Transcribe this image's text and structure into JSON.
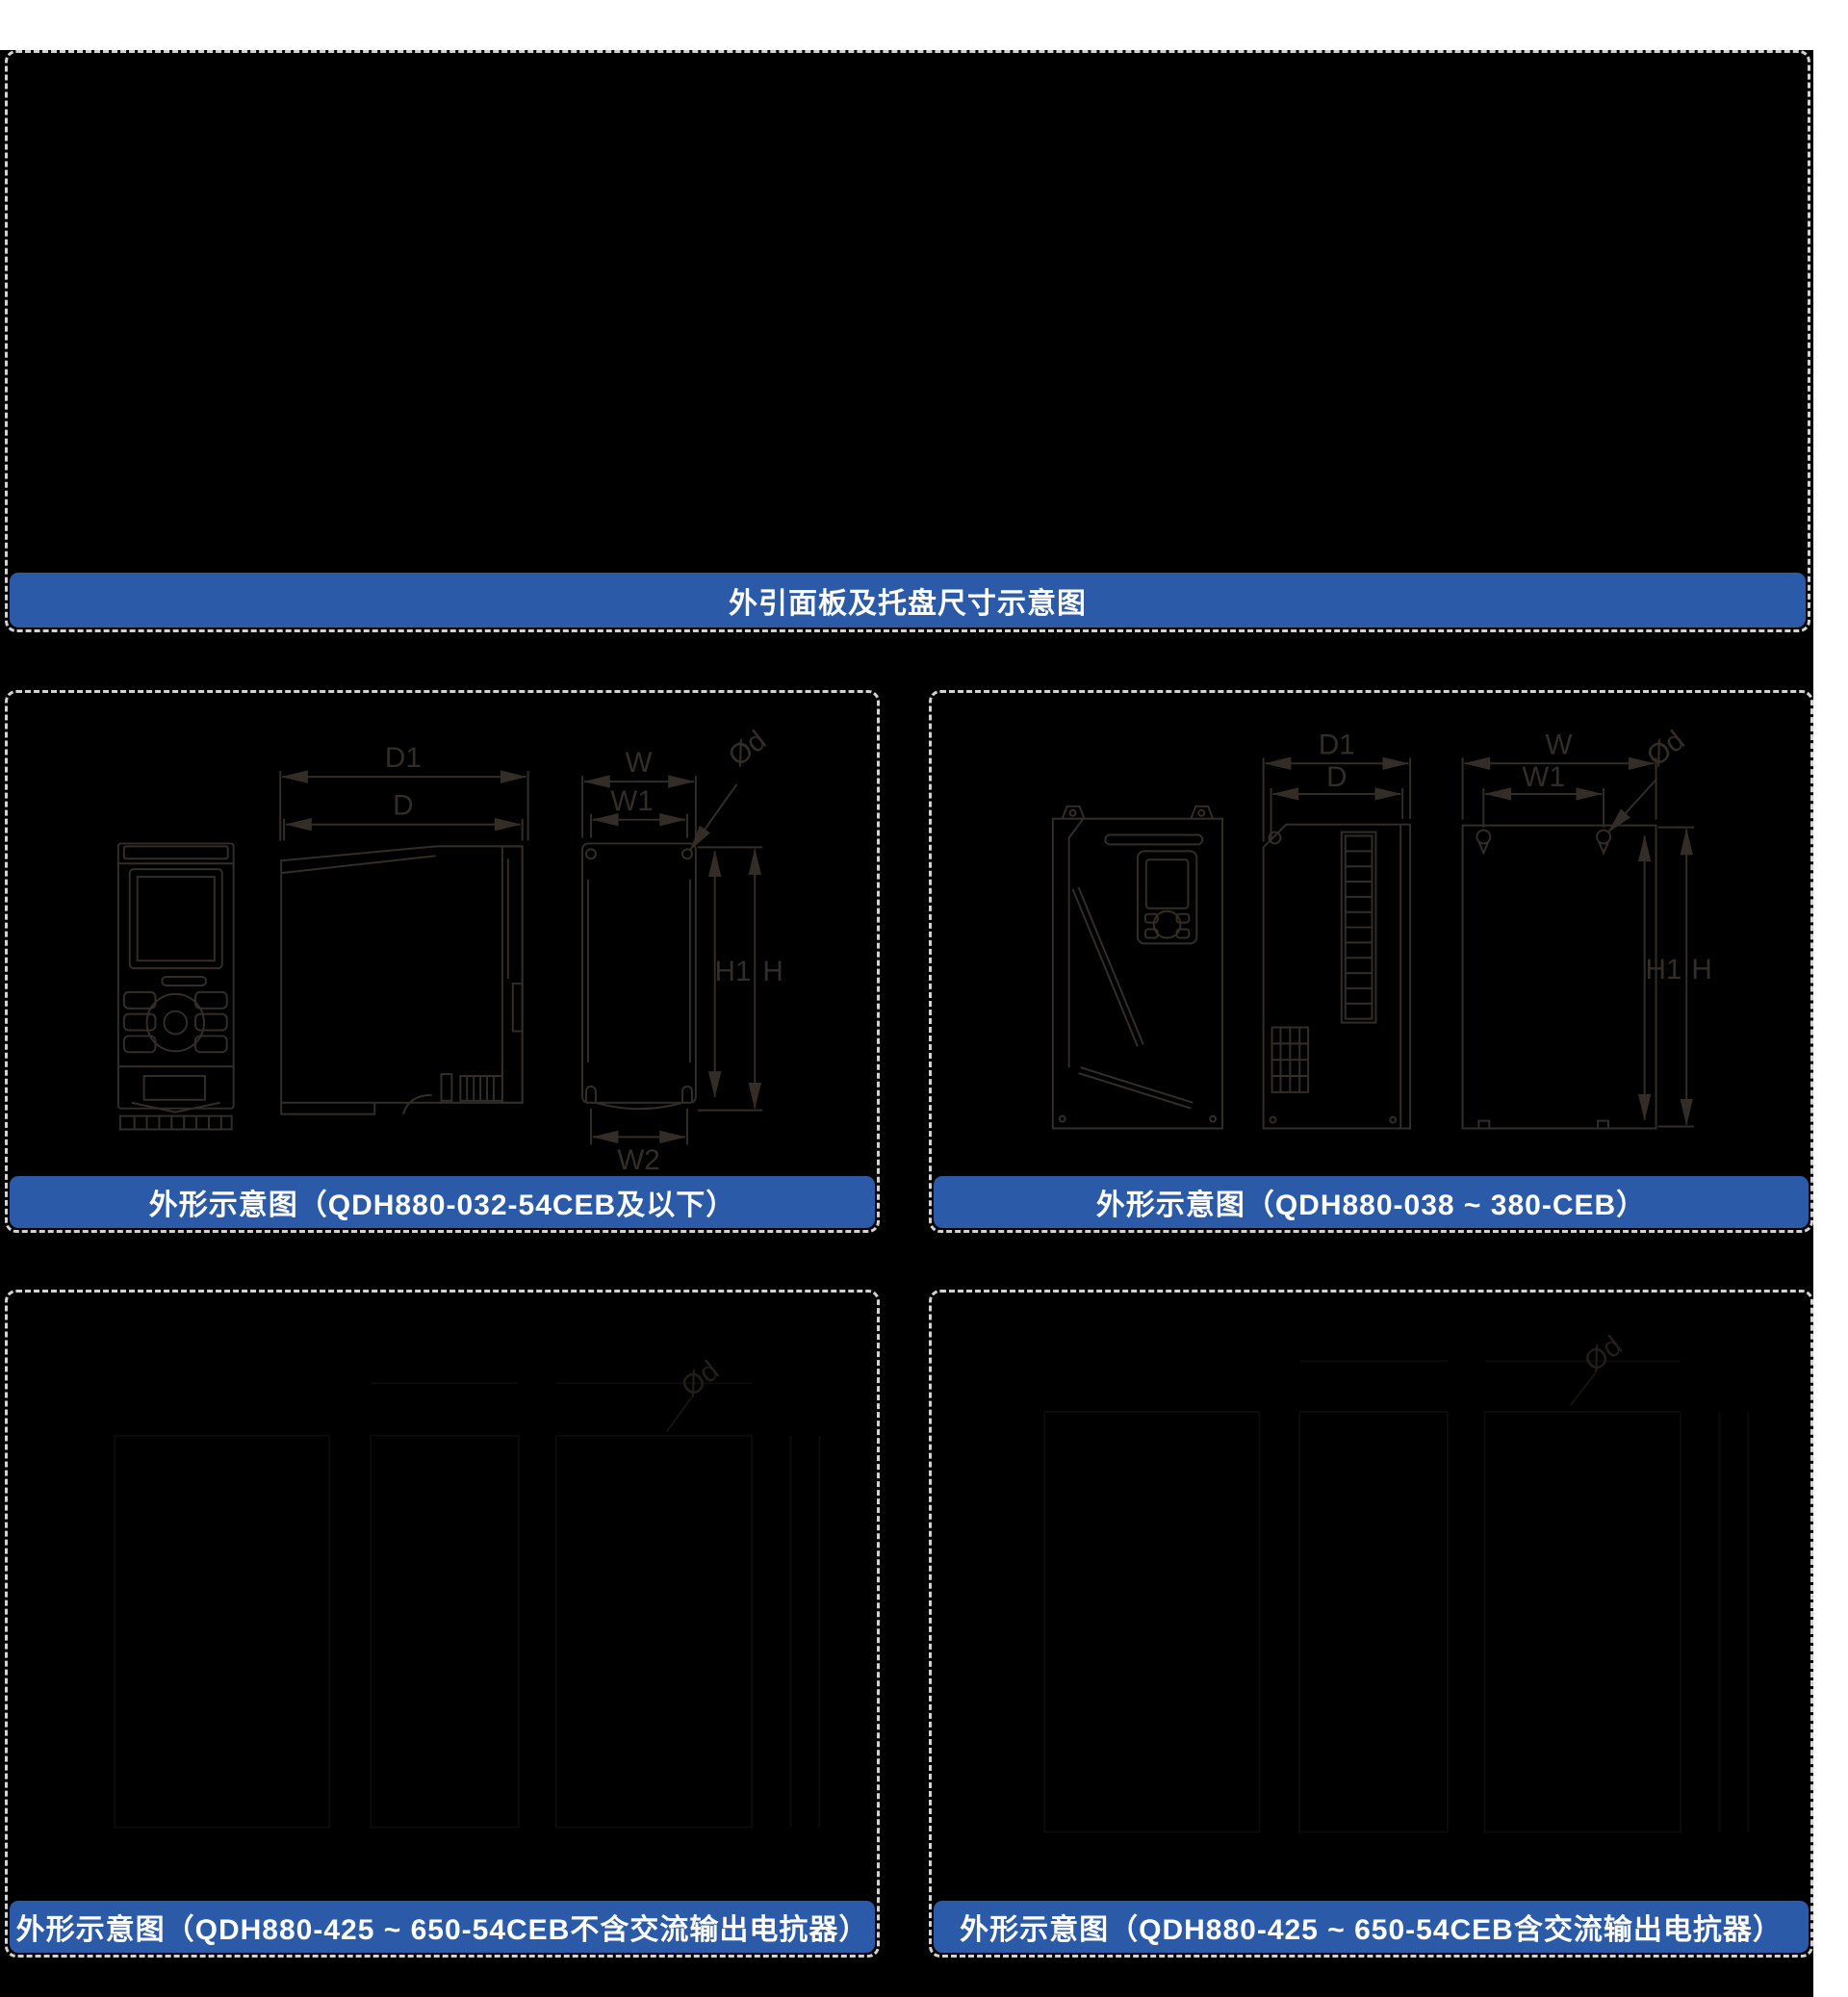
{
  "theme": {
    "page_background": "#ffffff",
    "canvas_background": "#000000",
    "banner_blue": "#2b5aa8",
    "banner_text_color": "#ffffff",
    "dashed_border": "#d2d2d2",
    "drawing_line": "#342d27",
    "faint_drawing_line": "#0b0b0b",
    "faint_label": "#241e18"
  },
  "header_banner": {
    "title": "外引面板及托盘尺寸示意图"
  },
  "panels": {
    "small": {
      "title": "外形示意图（QDH880-032-54CEB及以下）"
    },
    "mid": {
      "title": "外形示意图（QDH880-038 ~ 380-CEB）"
    },
    "large_no_reactor": {
      "title": "外形示意图（QDH880-425 ~ 650-54CEB不含交流输出电抗器）"
    },
    "large_with_reactor": {
      "title": "外形示意图（QDH880-425 ~ 650-54CEB含交流输出电抗器）"
    }
  },
  "dim_labels": {
    "d1": "D1",
    "d": "D",
    "w": "W",
    "w1": "W1",
    "od": "Ød",
    "h1": "H1",
    "h": "H",
    "w2": "W2"
  }
}
